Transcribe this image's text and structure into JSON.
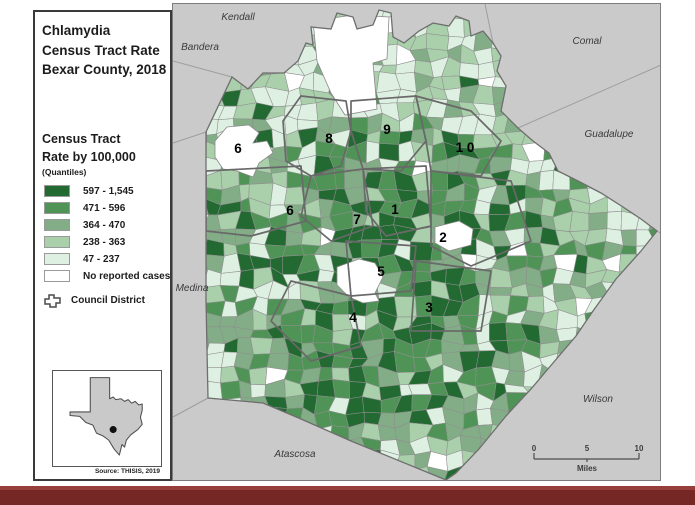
{
  "header": {
    "title_lines": [
      "Chlamydia",
      "Census Tract Rate",
      "Bexar County, 2018"
    ]
  },
  "legend": {
    "section_title_lines": [
      "Census Tract",
      "Rate by 100,000"
    ],
    "subtitle": "(Quantiles)",
    "classes": [
      {
        "label": "597 - 1,545",
        "color": "#236932"
      },
      {
        "label": "471 - 596",
        "color": "#4f9356"
      },
      {
        "label": "364 - 470",
        "color": "#82ad86"
      },
      {
        "label": "238 - 363",
        "color": "#a9cfab"
      },
      {
        "label": "47 - 237",
        "color": "#def0e2"
      },
      {
        "label": "No reported cases",
        "color": "#ffffff"
      }
    ],
    "council_district_label": "Council District",
    "source": "Source: THISIS, 2019"
  },
  "map": {
    "background_color": "#cacaca",
    "tract_stroke_color": "#8f8f8f",
    "district_outline_color": "#696969",
    "county_labels": [
      {
        "name": "Kendall",
        "x": 237,
        "y": 19
      },
      {
        "name": "Bandera",
        "x": 199,
        "y": 49
      },
      {
        "name": "Comal",
        "x": 586,
        "y": 43
      },
      {
        "name": "Guadalupe",
        "x": 608,
        "y": 136
      },
      {
        "name": "Medina",
        "x": 191,
        "y": 290
      },
      {
        "name": "Atascosa",
        "x": 294,
        "y": 456
      },
      {
        "name": "Wilson",
        "x": 597,
        "y": 401
      }
    ],
    "district_labels": [
      {
        "num": "8",
        "x": 328,
        "y": 142
      },
      {
        "num": "9",
        "x": 386,
        "y": 133
      },
      {
        "num": "1 0",
        "x": 464,
        "y": 151
      },
      {
        "num": "6",
        "x": 237,
        "y": 152
      },
      {
        "num": "6",
        "x": 289,
        "y": 214
      },
      {
        "num": "7",
        "x": 356,
        "y": 223
      },
      {
        "num": "1",
        "x": 394,
        "y": 213
      },
      {
        "num": "2",
        "x": 442,
        "y": 241
      },
      {
        "num": "5",
        "x": 380,
        "y": 275
      },
      {
        "num": "4",
        "x": 352,
        "y": 321
      },
      {
        "num": "3",
        "x": 428,
        "y": 311
      }
    ],
    "scale_bar": {
      "ticks": [
        "0",
        "5",
        "10"
      ],
      "unit": "Miles"
    }
  }
}
